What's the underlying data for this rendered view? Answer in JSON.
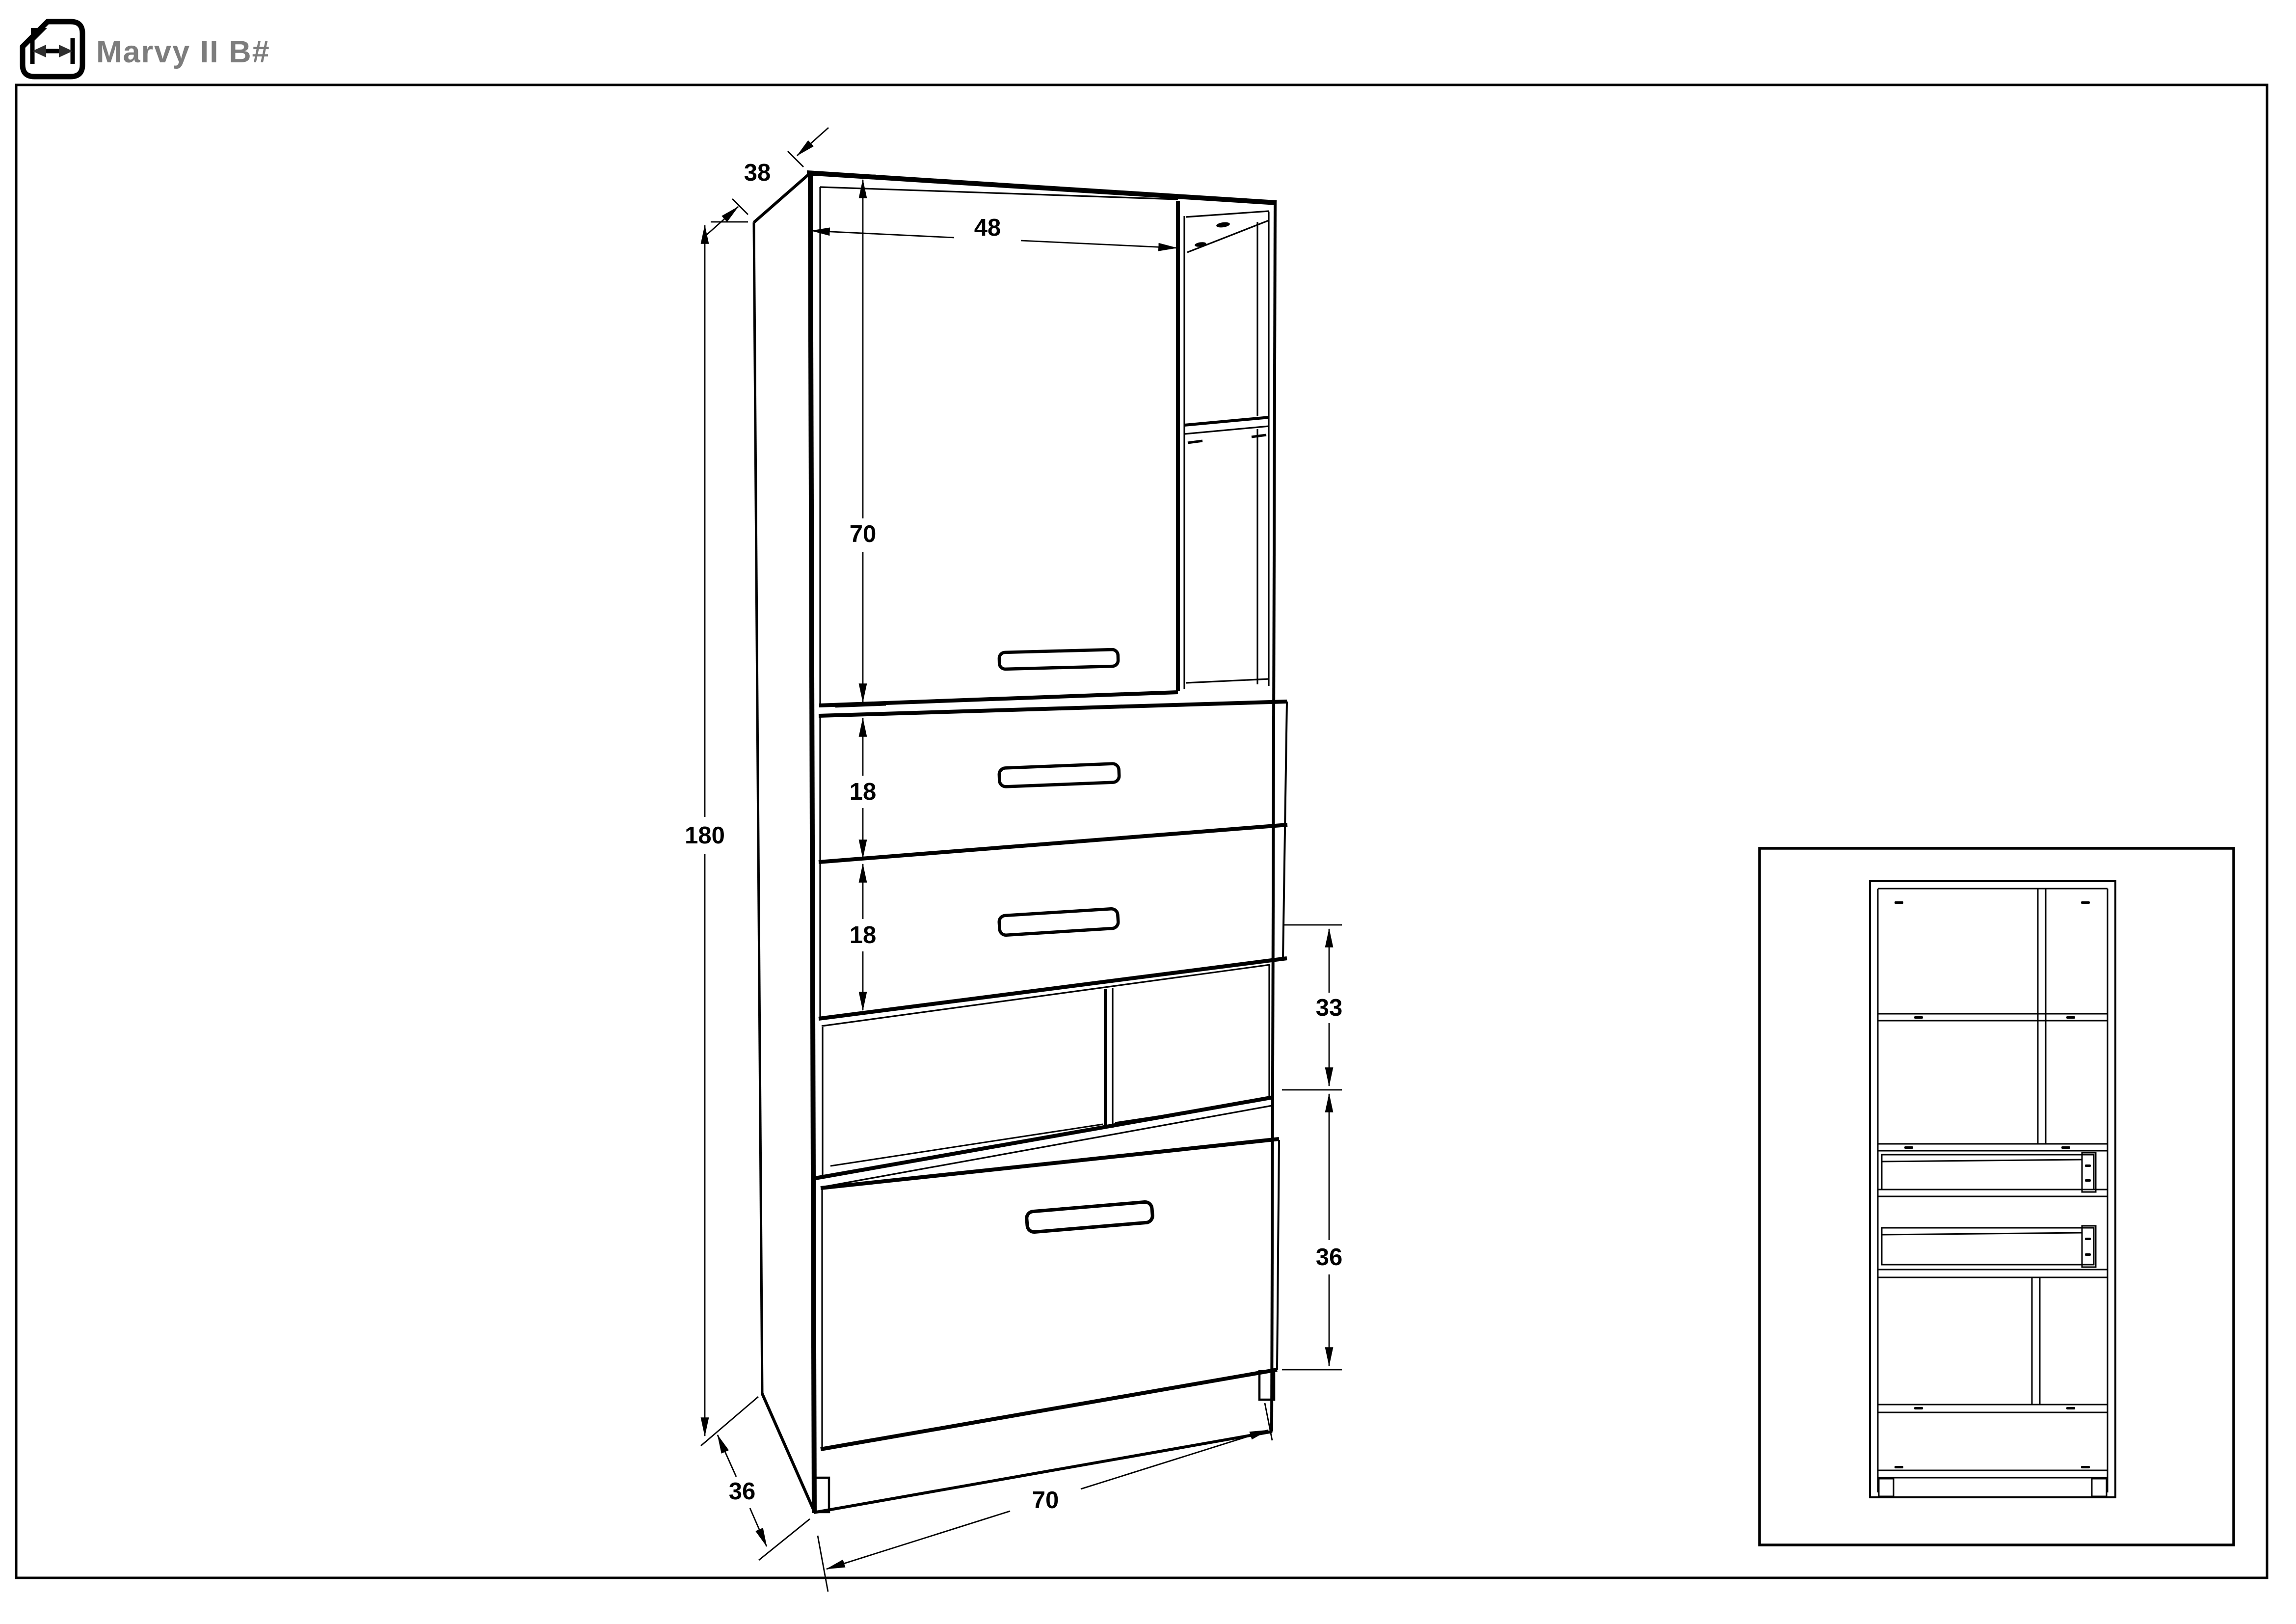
{
  "header": {
    "title": "Marvy II B#",
    "icon": "dimension-document-icon"
  },
  "drawing": {
    "views": {
      "main": "cabinet-isometric-view",
      "inset": "cabinet-front-open-view"
    },
    "dimensions": {
      "top_depth": "38",
      "door_width": "48",
      "door_height": "70",
      "overall_height": "180",
      "upper_drawer_height": "18",
      "lower_drawer_height": "18",
      "niche_height": "33",
      "flap_height": "36",
      "base_depth": "36",
      "overall_width": "70"
    }
  },
  "colors": {
    "line": "#000000",
    "title_gray": "#7d7d7d",
    "icon_dark": "#2e2e2e",
    "background": "#ffffff"
  }
}
